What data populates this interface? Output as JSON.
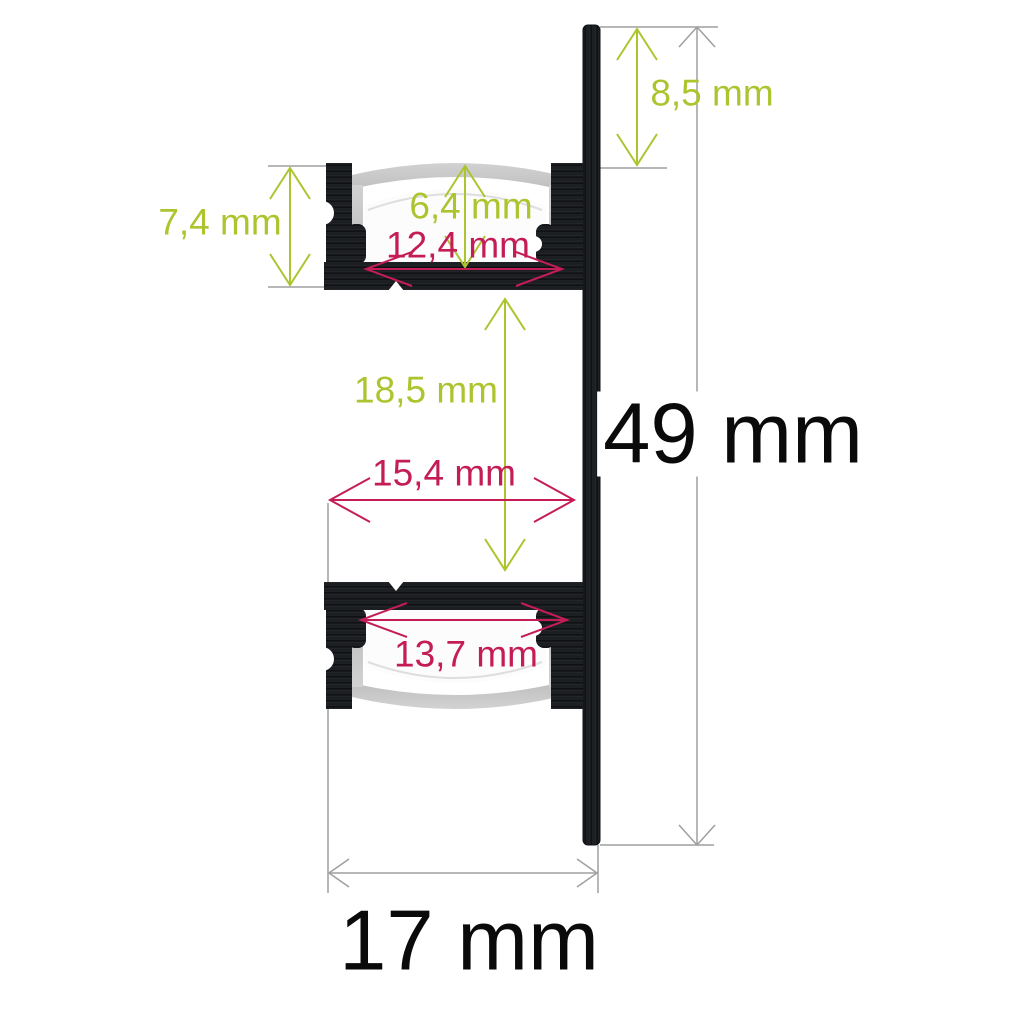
{
  "diagram": {
    "type": "technical-cross-section",
    "subject": "LED aluminium wall profile with two lamp channels and diffusers",
    "dimensions": {
      "top_offset": "8,5 mm",
      "upper_channel_height": "7,4 mm",
      "upper_inner_height": "6,4 mm",
      "upper_inner_width": "12,4 mm",
      "channel_gap_height": "18,5 mm",
      "channel_gap_width": "15,4 mm",
      "lower_inner_width": "13,7 mm",
      "total_height": "49 mm",
      "total_depth": "17 mm"
    },
    "colors": {
      "dimension_green": "#aec42f",
      "dimension_pink": "#c41d56",
      "dimension_gray": "#9f9f9f",
      "profile_black": "#1a1c1f",
      "diffuser_gray": "#c7c7c7",
      "large_text_black": "#0a0a0a",
      "background": "#ffffff"
    }
  }
}
